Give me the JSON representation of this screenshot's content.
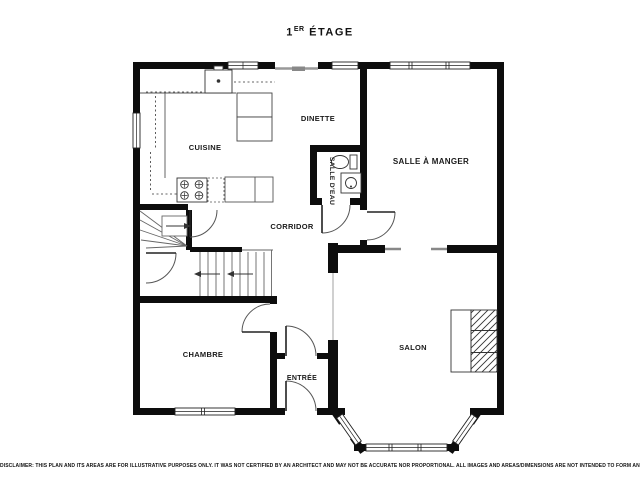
{
  "title": {
    "number": "1",
    "superscript": "ER",
    "word": "ÉTAGE"
  },
  "rooms": {
    "kitchen": "CUISINE",
    "dinette": "DINETTE",
    "dining_room": "SALLE À MANGER",
    "bathroom": "SALLE D'EAU",
    "corridor": "CORRIDOR",
    "bedroom": "CHAMBRE",
    "entrance": "ENTRÉE",
    "living_room": "SALON"
  },
  "disclaimer": "DISCLAIMER: THIS PLAN AND ITS AREAS ARE FOR ILLUSTRATIVE PURPOSES ONLY. IT WAS NOT CERTIFIED BY AN ARCHITECT AND MAY NOT BE ACCURATE NOR PROPORTIONAL. ALL IMAGES AND AREAS/DIMENSIONS ARE NOT INTENDED TO FORM ANY CONTRACT OR WARRANTY.",
  "colors": {
    "wall": "#0d0d0d",
    "thin_line": "#555555",
    "background": "#ffffff"
  }
}
